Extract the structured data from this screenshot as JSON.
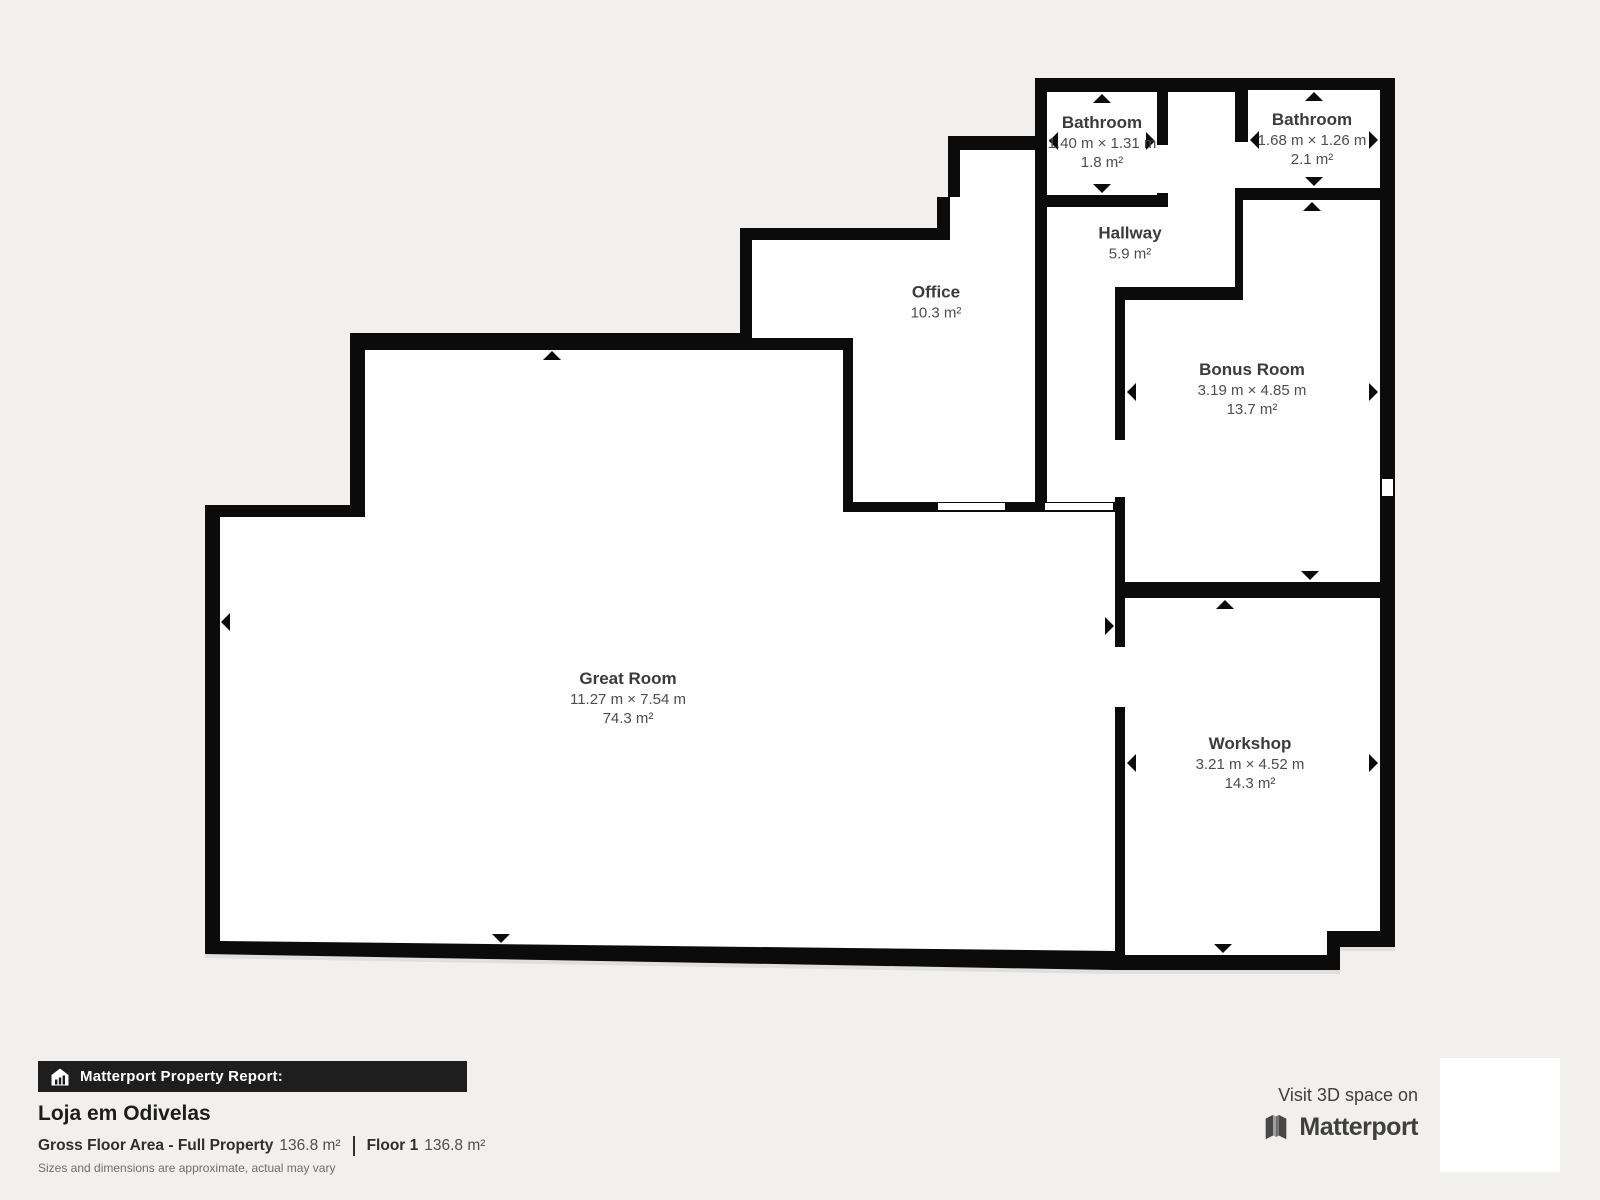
{
  "floorplan": {
    "rooms": [
      {
        "id": "bathroom-1",
        "name": "Bathroom",
        "dimensions": "1.40 m × 1.31 m",
        "area": "1.8 m²"
      },
      {
        "id": "bathroom-2",
        "name": "Bathroom",
        "dimensions": "1.68 m × 1.26 m",
        "area": "2.1 m²"
      },
      {
        "id": "hallway",
        "name": "Hallway",
        "area": "5.9 m²"
      },
      {
        "id": "office",
        "name": "Office",
        "area": "10.3 m²"
      },
      {
        "id": "bonus-room",
        "name": "Bonus Room",
        "dimensions": "3.19 m × 4.85 m",
        "area": "13.7 m²"
      },
      {
        "id": "great-room",
        "name": "Great Room",
        "dimensions": "11.27 m × 7.54 m",
        "area": "74.3 m²"
      },
      {
        "id": "workshop",
        "name": "Workshop",
        "dimensions": "3.21 m × 4.52 m",
        "area": "14.3 m²"
      }
    ]
  },
  "footer": {
    "report_label": "Matterport Property Report:",
    "property_name": "Loja em Odivelas",
    "gross_floor_area_label": "Gross Floor Area - Full Property",
    "gross_floor_area_value": "136.8 m²",
    "floor_label": "Floor 1",
    "floor_value": "136.8 m²",
    "disclaimer": "Sizes and dimensions are approximate, actual may vary"
  },
  "promo": {
    "visit_text": "Visit 3D space on",
    "brand": "Matterport"
  },
  "colors": {
    "background": "#f1f0ee",
    "wall": "#0b0b0b",
    "room_fill": "#ffffff",
    "label_text": "#3b3b3b",
    "report_bar_bg": "#1e1e1e"
  }
}
